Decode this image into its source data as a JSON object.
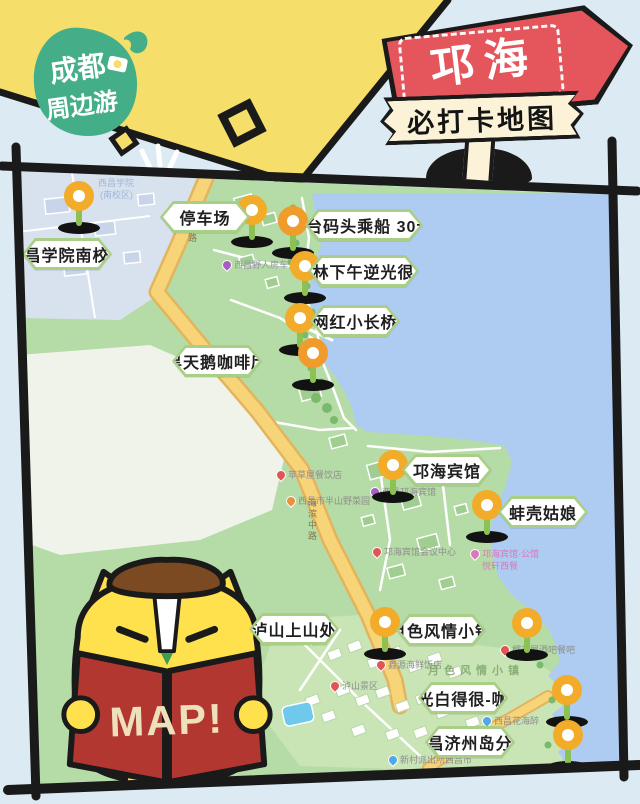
{
  "logo": {
    "line1": "成都",
    "line2": "周边游",
    "color": "#43AE87"
  },
  "sign": {
    "title": "邛海",
    "subtitle": "必打卡地图",
    "arrow_color": "#E4555C",
    "banner_color": "#FBF2D7"
  },
  "mascot": {
    "book_text": "MAP!",
    "book_color": "#B23730",
    "body_color": "#FFE14D"
  },
  "map": {
    "water_color": "#AECBF2",
    "land_color": "#B5DBA6",
    "campus_color": "#D8E2EF",
    "road_color": "#F8D478",
    "tag_border_color": "#A9CE85",
    "points": [
      {
        "id": "campus",
        "label": "西昌学院南校区",
        "tag_x": 22,
        "tag_y": 238,
        "pin_x": 79,
        "pin_y": 196,
        "pin_color": "#F2AC2A"
      },
      {
        "id": "parking",
        "label": "停车场",
        "tag_x": 160,
        "tag_y": 201,
        "pin_x": 252,
        "pin_y": 210,
        "pin_color": "#F2AC2A"
      },
      {
        "id": "boat",
        "label": "钓鱼台码头乘船 30元/人",
        "tag_x": 305,
        "tag_y": 209,
        "pin_x": 293,
        "pin_y": 221,
        "pin_color": "#EF9C2D"
      },
      {
        "id": "grove",
        "label": "小树林下午逆光很好看",
        "tag_x": 308,
        "tag_y": 255,
        "pin_x": 305,
        "pin_y": 266,
        "pin_color": "#F2AC2A"
      },
      {
        "id": "bridge",
        "label": "网红小长桥",
        "tag_x": 310,
        "tag_y": 305,
        "pin_x": 300,
        "pin_y": 318,
        "pin_color": "#F2AC2A"
      },
      {
        "id": "swan-cafe",
        "label": "黑天鹅咖啡厅",
        "tag_x": 172,
        "tag_y": 345,
        "pin_x": 313,
        "pin_y": 353,
        "pin_color": "#EF9C2D"
      },
      {
        "id": "hotel",
        "label": "邛海宾馆",
        "tag_x": 402,
        "tag_y": 454,
        "pin_x": 393,
        "pin_y": 465,
        "pin_color": "#F2AC2A"
      },
      {
        "id": "clam",
        "label": "蚌壳姑娘",
        "tag_x": 498,
        "tag_y": 496,
        "pin_x": 487,
        "pin_y": 505,
        "pin_color": "#F2AC2A"
      },
      {
        "id": "lushan",
        "label": "泸山上山处",
        "tag_x": 249,
        "tag_y": 613,
        "pin_x": 385,
        "pin_y": 622,
        "pin_color": "#F2AC2A"
      },
      {
        "id": "moon-town",
        "label": "月色风情小镇",
        "tag_x": 396,
        "tag_y": 614,
        "pin_x": 527,
        "pin_y": 623,
        "pin_color": "#F2AC2A"
      },
      {
        "id": "moonlight",
        "label": "月光白得很-咖啡",
        "tag_x": 418,
        "tag_y": 682,
        "pin_x": 567,
        "pin_y": 690,
        "pin_color": "#F2AC2A"
      },
      {
        "id": "jeju",
        "label": "西昌济州岛分岛",
        "tag_x": 425,
        "tag_y": 726,
        "pin_x": 568,
        "pin_y": 735,
        "pin_color": "#F2AC2A"
      }
    ],
    "pois": [
      {
        "text": "西昌学院",
        "x": 98,
        "y": 176,
        "icon": "",
        "color": "#9FB6D6"
      },
      {
        "text": "(南校区)",
        "x": 100,
        "y": 188,
        "icon": "",
        "color": "#9FB6D6"
      },
      {
        "text": "西昌野人房车营地",
        "x": 222,
        "y": 258,
        "icon": "#A85CC4",
        "color": "#9A92A8"
      },
      {
        "text": "苹草屋餐饮店",
        "x": 276,
        "y": 468,
        "icon": "#E05555",
        "color": "#8E8E8E"
      },
      {
        "text": "西昌市半山野菜园",
        "x": 286,
        "y": 494,
        "icon": "#E8923F",
        "color": "#8E8E8E"
      },
      {
        "text": "西昌邛海宾馆",
        "x": 370,
        "y": 485,
        "icon": "#A85CC4",
        "color": "#8E8E8E"
      },
      {
        "text": "邛海宾馆会议中心",
        "x": 372,
        "y": 545,
        "icon": "#E05555",
        "color": "#8E8E8E"
      },
      {
        "text": "邛海宾馆·公馆",
        "x": 470,
        "y": 547,
        "icon": "#D87AB8",
        "color": "#D87AB8"
      },
      {
        "text": "悦轩西餐",
        "x": 482,
        "y": 559,
        "icon": "",
        "color": "#D87AB8"
      },
      {
        "text": "鑫源海鲜饭店",
        "x": 376,
        "y": 658,
        "icon": "#E05555",
        "color": "#8E8E8E"
      },
      {
        "text": "樱花屋酒吧餐吧",
        "x": 500,
        "y": 643,
        "icon": "#E05555",
        "color": "#8E8E8E"
      },
      {
        "text": "泸山景区",
        "x": 330,
        "y": 679,
        "icon": "#E05555",
        "color": "#8E8E8E"
      },
      {
        "text": "西昌花海醉",
        "x": 482,
        "y": 714,
        "icon": "#4FA8E8",
        "color": "#8E8E8E"
      },
      {
        "text": "新村派出所西昌市",
        "x": 388,
        "y": 753,
        "icon": "#4FA8E8",
        "color": "#8E8E8E"
      }
    ],
    "road_labels": [
      {
        "text": "中路",
        "x": 186,
        "y": 222
      },
      {
        "text": "海滨中路",
        "x": 306,
        "y": 498
      }
    ],
    "area_labels": [
      {
        "text": "月色风情小镇",
        "x": 428,
        "y": 662,
        "color": "#7FA86A"
      }
    ]
  }
}
